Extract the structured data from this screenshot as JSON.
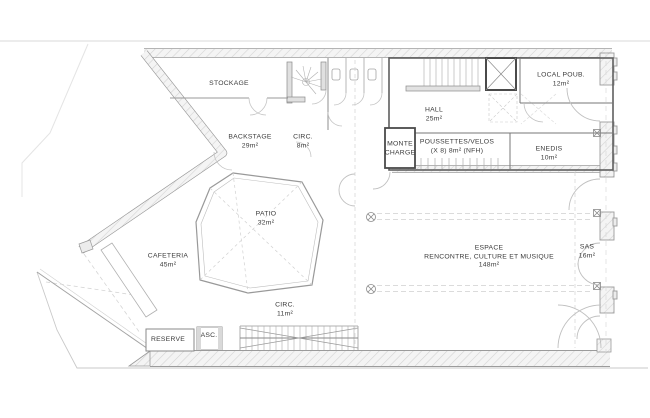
{
  "plan_title": "floor-plan",
  "colors": {
    "background": "#ffffff",
    "wall_line": "#9b9b9b",
    "heavy_line": "#5f5f5f",
    "hatch": "#d4d4d4",
    "dashed_line": "#cfcfcf",
    "text": "#3a3a3a"
  },
  "rooms": [
    {
      "name": "STOCKAGE"
    },
    {
      "name": "BACKSTAGE",
      "area": "29m²"
    },
    {
      "name": "CIRC.",
      "area": "8m²"
    },
    {
      "name": "PATIO",
      "area": "32m²"
    },
    {
      "name": "CAFETERIA",
      "area": "45m²"
    },
    {
      "name": "CIRC.",
      "area": "11m²"
    },
    {
      "name": "RESERVE"
    },
    {
      "name": "ASC."
    },
    {
      "name": "HALL",
      "area": "25m²"
    },
    {
      "name": "MONTE CHARGE"
    },
    {
      "name": "POUSSETTES/VELOS",
      "area": "(X 8) 8m² (NFH)"
    },
    {
      "name": "ENEDIS",
      "area": "10m²"
    },
    {
      "name": "LOCAL POUB.",
      "area": "12m²"
    },
    {
      "name": "ESPACE",
      "line2": "RENCONTRE, CULTURE ET MUSIQUE",
      "area": "148m²"
    },
    {
      "name": "SAS",
      "area": "16m²"
    }
  ]
}
